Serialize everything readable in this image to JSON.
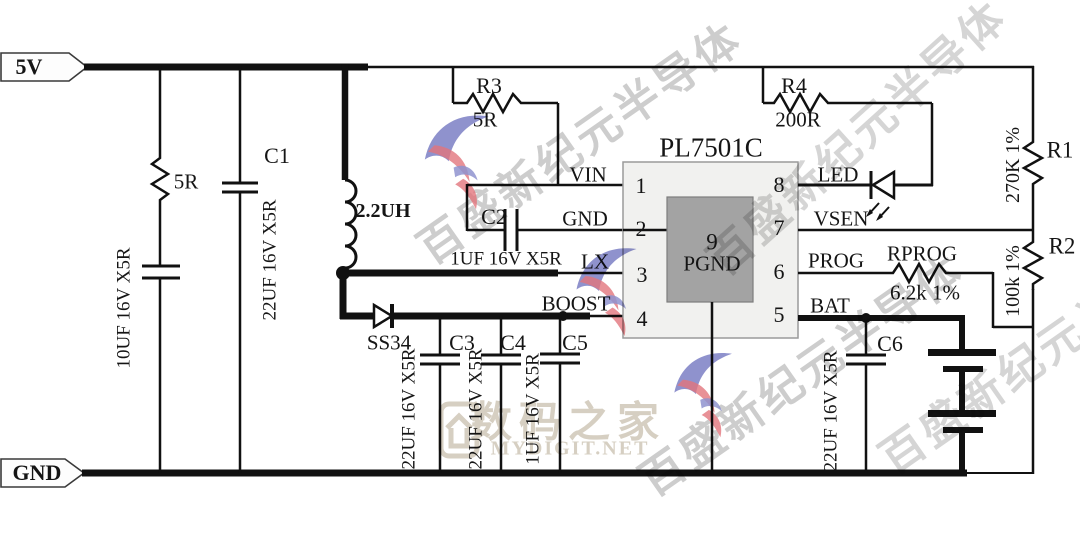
{
  "rails": {
    "vcc": "5V",
    "gnd": "GND"
  },
  "ic": {
    "title": "PL7501C",
    "pad": {
      "number": "9",
      "name": "PGND"
    },
    "pins": [
      {
        "number": "1",
        "name": "VIN"
      },
      {
        "number": "2",
        "name": "GND"
      },
      {
        "number": "3",
        "name": "LX"
      },
      {
        "number": "4",
        "name": "BOOST"
      },
      {
        "number": "5",
        "name": "BAT"
      },
      {
        "number": "6",
        "name": "PROG"
      },
      {
        "number": "7",
        "name": "VSEN"
      },
      {
        "number": "8",
        "name": "LED"
      }
    ]
  },
  "components": {
    "r_in": {
      "value": "5R"
    },
    "c_in": {
      "value": "10UF 16V X5R"
    },
    "c1": {
      "ref": "C1",
      "value": "22UF 16V X5R"
    },
    "l1": {
      "value": "2.2UH"
    },
    "r3": {
      "ref": "R3",
      "value": "5R"
    },
    "r4": {
      "ref": "R4",
      "value": "200R"
    },
    "c2": {
      "ref": "C2",
      "value": "1UF 16V X5R"
    },
    "d1": {
      "ref": "SS34"
    },
    "c3": {
      "ref": "C3",
      "value": "22UF 16V X5R"
    },
    "c4": {
      "ref": "C4",
      "value": "22UF 16V X5R"
    },
    "c5": {
      "ref": "C5",
      "value": "1UF 16V X5R"
    },
    "r1": {
      "ref": "R1",
      "value": "270K 1%"
    },
    "r2": {
      "ref": "R2",
      "value": "100k 1%"
    },
    "rprog": {
      "ref": "RPROG",
      "value": "6.2k 1%"
    },
    "c6": {
      "ref": "C6",
      "value": "22UF 16V X5R"
    }
  },
  "watermarks": {
    "vendor": "百盛新纪元半导体",
    "site_name": "数码之家",
    "site_url": "MYDIGIT.NET"
  },
  "colors": {
    "wire": "#111111",
    "ic_fill": "#f1f1ef",
    "pad_fill": "#a3a3a3",
    "watermark_gray": "#9b9b9b",
    "watermark_beige": "#d6cfc2",
    "logo_blue": "#7b7fc4",
    "logo_red": "#e2767d"
  }
}
